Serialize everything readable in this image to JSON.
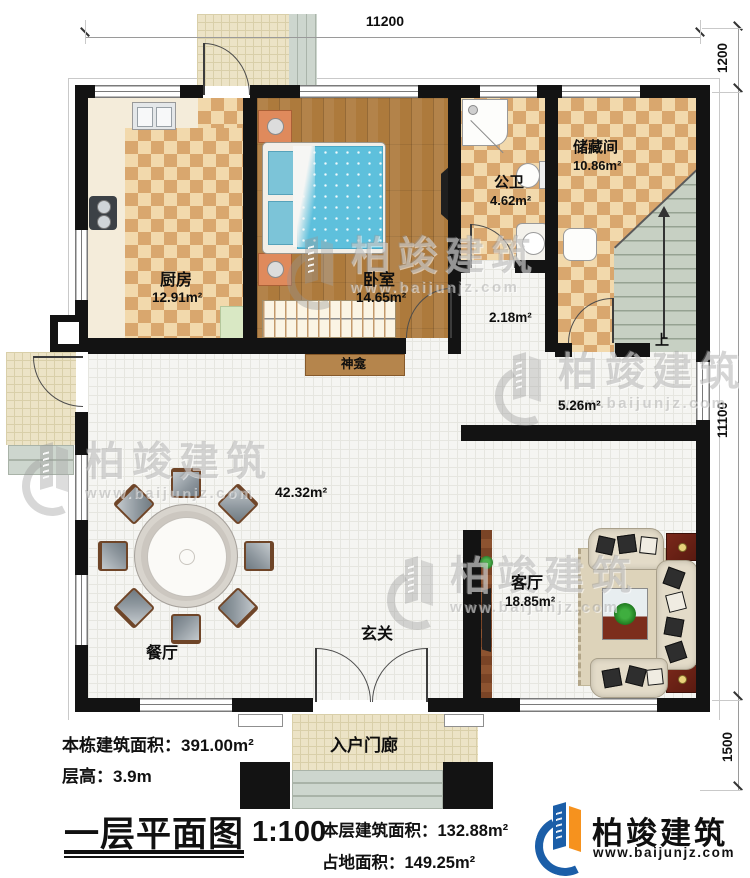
{
  "dims": {
    "top": "11200",
    "right_top": "1200",
    "right_mid": "11100",
    "right_bottom": "1500"
  },
  "rooms": {
    "kitchen": {
      "label": "厨房",
      "area": "12.91m²"
    },
    "bedroom": {
      "label": "卧室",
      "area": "14.65m²"
    },
    "bath": {
      "label": "公卫",
      "area": "4.62m²"
    },
    "storage": {
      "label": "储藏间",
      "area": "10.86m²"
    },
    "hall_area": "2.18m²",
    "corridor_area": "5.26m²",
    "great_room_area": "42.32m²",
    "dining_label": "餐厅",
    "foyer_label": "玄关",
    "living": {
      "label": "客厅",
      "area": "18.85m²"
    },
    "porch_label": "入户门廊",
    "shrine_label": "神龛",
    "stairs_up_label": "上"
  },
  "footer": {
    "total_area": "本栋建筑面积：391.00m²",
    "floor_height": "层高：3.9m",
    "title": "一层平面图",
    "scale": "1:100",
    "floor_area": "本层建筑面积：132.88m²",
    "footprint": "占地面积：149.25m²"
  },
  "brand": {
    "name": "柏竣建筑",
    "url": "www.baijunjz.com",
    "blue": "#1b5ea8",
    "orange": "#f6921e"
  },
  "watermark": {
    "name": "柏竣建筑",
    "url": "www.baijunjz.com"
  }
}
